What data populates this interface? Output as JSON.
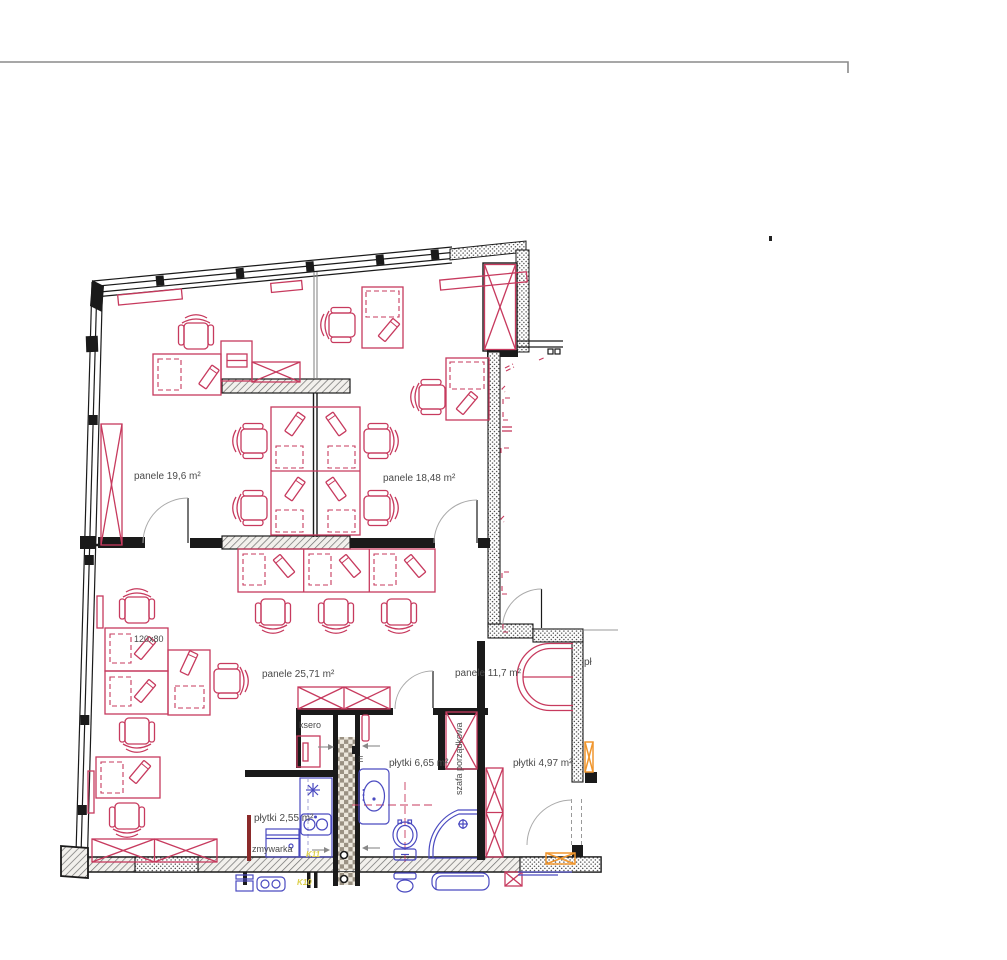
{
  "labels": {
    "office_left": "panele 19,6  m²",
    "office_right": "panele 18,48  m²",
    "open_office": "panele 25,71  m²",
    "lounge": "panele 11,7  m²",
    "bathroom": "płytki 6,65  m²",
    "entry_hall": "płytki 4,97  m²",
    "kitchenette": "płytki 2,55  m²",
    "dishwasher": "zmywarka",
    "copier_room": "ksero",
    "cleaning_closet": "szafa porządkowa",
    "desk_size": "120x80",
    "electric_meter": "E",
    "clipped_label_right": "pł",
    "code_kitchen": "K11",
    "code_below_wall": "K10"
  },
  "colors": {
    "furniture_red": "#c73a5e",
    "sanitary_blue": "#4a4ac0",
    "accent_orange": "#f0962e",
    "code_yellow": "#ddd04a",
    "wall_black": "#1a1a1a",
    "label_gray": "#4a4a4a"
  }
}
